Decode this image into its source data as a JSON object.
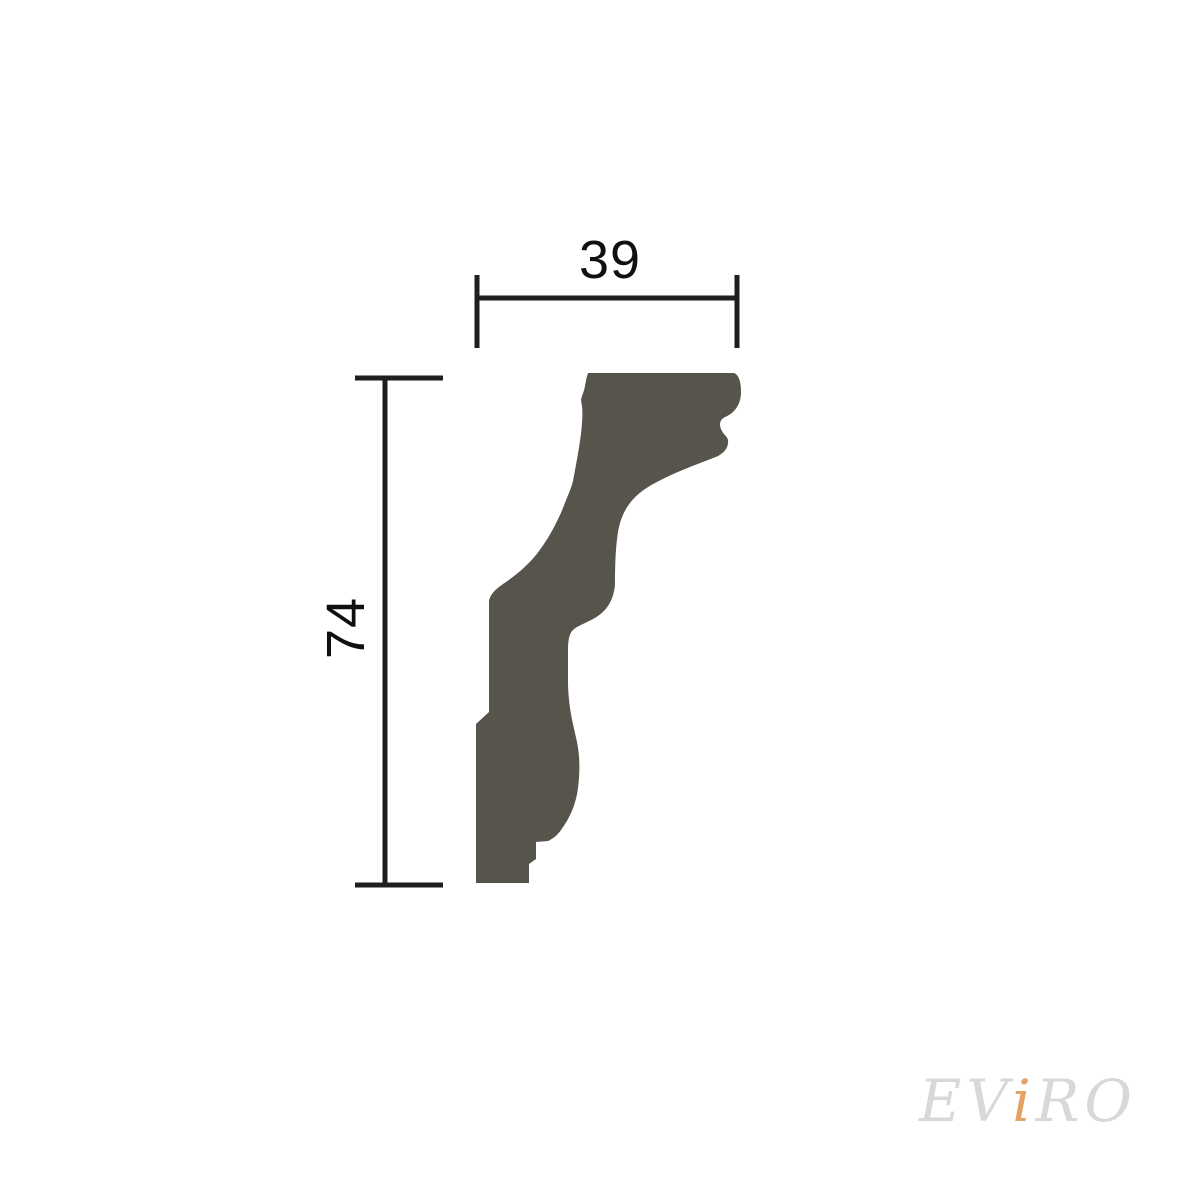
{
  "figure": {
    "title": "molding-profile-cross-section-technical-drawing",
    "dimensions": {
      "width_label": "39",
      "height_label": "74"
    },
    "profile": {
      "fill": "#57544C",
      "path": "M 588 373 L 734 373 C 739 375 741 382 741 392 C 741 404 735 413 725 417 C 719 420 719 426 722 431 C 724 435 727 436 728 440 C 729 449 722 455 713 458 C 690 467 665 476 645 489 C 629 500 621 514 618 532 C 616 545 615 560 615 585 C 613 604 604 613 593 619 C 584 624 577 626 573 630 C 569 634 568 641 568 650 L 568 685 C 569 712 574 727 577 742 C 580 757 580 772 578 788 C 576 804 570 818 561 830 C 557 836 552 839 548 841 L 536 842 L 536 859 L 529 864 L 529 883 L 476 883 L 476 724 L 489 712 L 489 601 C 490 594 496 589 503 584 C 515 576 527 566 536 555 C 547 541 556 525 563 508 C 568 495 571 489 573 481 C 576 465 579 449 581 434 C 582 424 583 414 582 406 L 581 400 C 582 395 584 392 585 386 C 586 380 587 376 588 373 Z"
    }
  },
  "watermark": {
    "part1": "EV",
    "accent": "i",
    "part2": "RO",
    "full_text": "EViRO",
    "color": "#D8D8D8",
    "accent_color": "#E4A265"
  },
  "colors": {
    "background": "#FFFFFF",
    "dimension_lines": "#1E1E1E",
    "dimension_text": "#101010"
  }
}
